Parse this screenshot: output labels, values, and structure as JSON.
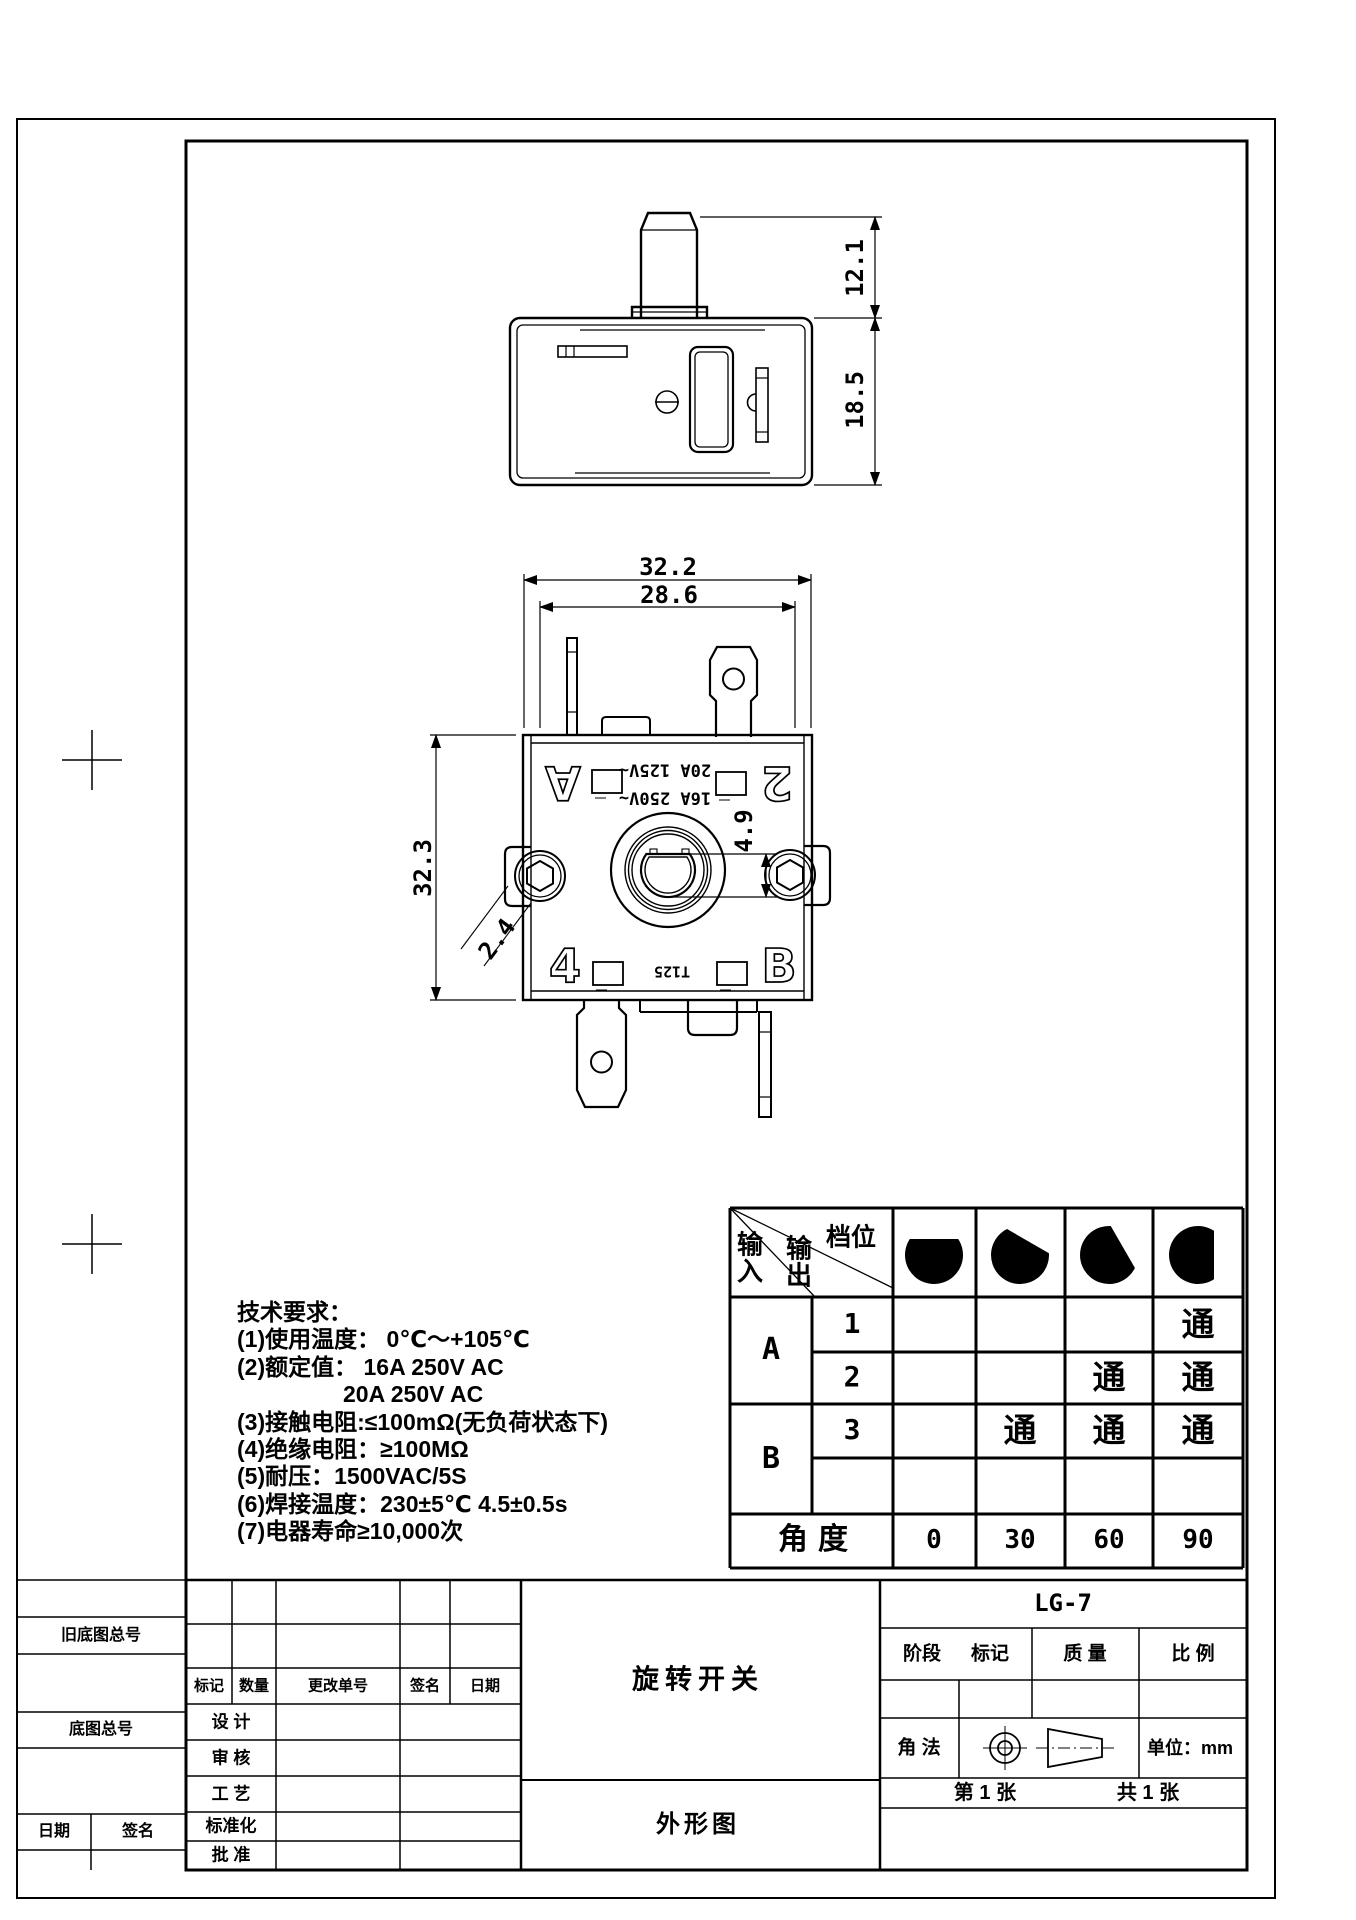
{
  "drawing": {
    "product_name": "旋转开关",
    "view_label": "外形图",
    "model": "LG-7"
  },
  "dimensions": {
    "shaft_height": "12.1",
    "body_height": "18.5",
    "overall_width": "32.2",
    "inner_width": "28.6",
    "face_height": "32.3",
    "dhole_depth": "4.9",
    "hex_width": "2.4"
  },
  "markings": {
    "corner_a": "A",
    "corner_2": "2",
    "corner_4": "4",
    "corner_b": "B",
    "rating_top": "20A 125V~",
    "rating_bottom": "16A 250V~",
    "type_code": "T125"
  },
  "tech_requirements": {
    "title": "技术要求：",
    "lines": [
      "(1)使用温度：  0℃～+105℃",
      "(2)额定值：  16A 250V AC",
      "20A 250V AC",
      "(3)接触电阻:≤100mΩ(无负荷状态下)",
      "(4)绝缘电阻：≥100MΩ",
      "(5)耐压：1500VAC/5S",
      "(6)焊接温度：230±5℃ 4.5±0.5s",
      "(7)电器寿命≥10,000次"
    ]
  },
  "function_table": {
    "corner": {
      "input": "输入",
      "output": "输出",
      "gear": "档位"
    },
    "knob_angles": [
      0,
      30,
      60,
      90
    ],
    "groups": [
      {
        "label": "A"
      },
      {
        "label": "B"
      }
    ],
    "rows": [
      {
        "gear": "1",
        "states": [
          "",
          "",
          "",
          "通"
        ]
      },
      {
        "gear": "2",
        "states": [
          "",
          "",
          "通",
          "通"
        ]
      },
      {
        "gear": "3",
        "states": [
          "",
          "通",
          "通",
          "通"
        ]
      },
      {
        "gear": "",
        "states": [
          "",
          "",
          "",
          ""
        ]
      }
    ],
    "angle_row": {
      "label": "角度",
      "values": [
        "0",
        "30",
        "60",
        "90"
      ]
    },
    "on_symbol": "通"
  },
  "title_block": {
    "left": {
      "old_no": "旧底图总号",
      "no": "底图总号",
      "date": "日期",
      "sign": "签名"
    },
    "revision_headers": [
      "标记",
      "数量",
      "更改单号",
      "签名",
      "日期"
    ],
    "roles": [
      "设 计",
      "审 核",
      "工 艺",
      "标准化",
      "批 准"
    ],
    "stage": "阶段",
    "mark": "标记",
    "mass": "质 量",
    "scale": "比 例",
    "projection": "角 法",
    "unit": "单位：mm",
    "sheet": "第 1 张",
    "total": "共 1 张"
  },
  "colors": {
    "line": "#000000",
    "background": "#ffffff"
  }
}
